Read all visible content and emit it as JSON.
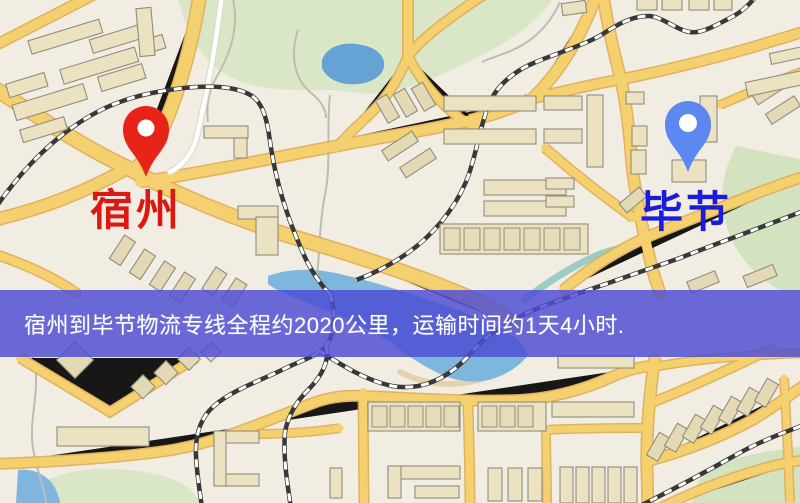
{
  "map": {
    "banner": {
      "text": "宿州到毕节物流专线全程约2020公里，运输时间约1天4小时.",
      "background": "#4d4dd2",
      "text_color": "#ffffff"
    },
    "markers": {
      "origin": {
        "label": "宿州",
        "icon": "red-map-pin-icon",
        "pin_color": "#e82318",
        "label_color": "#dd1712"
      },
      "destination": {
        "label": "毕节",
        "icon": "blue-map-pin-icon",
        "pin_color": "#5c88ef",
        "label_color": "#1b1bdd"
      }
    },
    "palette": {
      "background": "#f2ede3",
      "road_fill": "#f5d06e",
      "road_casing": "#e0ab55",
      "minor_road": "#ffffff",
      "water": "#7fb6de",
      "lake": "#64a3d4",
      "park": "#d9e7c6",
      "railway": "#383838",
      "building": "#ebe2c2"
    }
  }
}
